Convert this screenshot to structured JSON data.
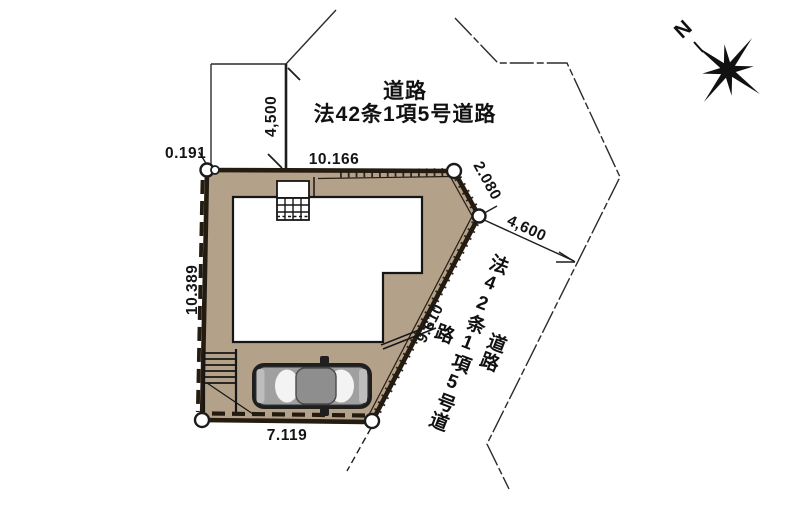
{
  "plan": {
    "road_label_top": {
      "line1": "道路",
      "line2": "法42条1項5号道路"
    },
    "road_label_right": {
      "line1": "道路",
      "line2": "法42条1項5号道路"
    },
    "compass": {
      "north_label": "N"
    },
    "dimensions": {
      "offset_top_left": "0.191",
      "road_width_top": "4,500",
      "edge_top": "10.166",
      "edge_top_right": "2.080",
      "road_width_right": "4,600",
      "edge_left": "10.389",
      "edge_diagonal_right": "9.610",
      "edge_bottom": "7.119"
    },
    "colors": {
      "lot_fill": "#b3a18a",
      "boundary": "#241b11",
      "building_fill": "#ffffff",
      "thin_line": "#2b2b2b",
      "car_body": "#a0a0a0"
    }
  }
}
